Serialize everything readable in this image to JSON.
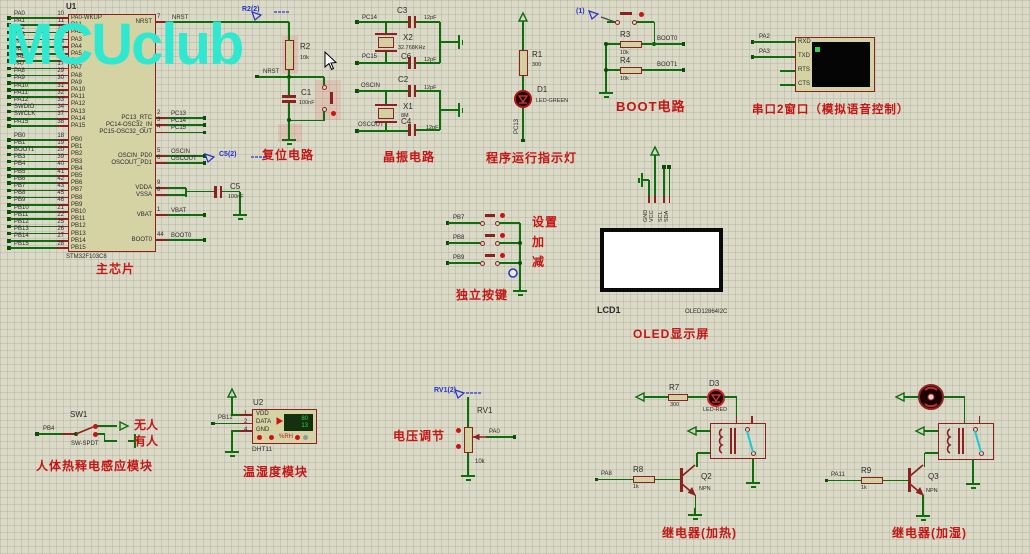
{
  "logo": {
    "text": "MCUclub"
  },
  "chip": {
    "ref": "U1",
    "part": "STM32F103C8",
    "caption": "主芯片",
    "left_pins_a": [
      [
        "PA0",
        "10",
        "PA0-WKUP"
      ],
      [
        "PA1",
        "11",
        "PA1"
      ],
      [
        "PA2",
        "12",
        "PA2"
      ],
      [
        "PA3",
        "13",
        "PA3"
      ],
      [
        "PA4",
        "14",
        "PA4"
      ],
      [
        "PA5",
        "15",
        "PA5"
      ],
      [
        "PA6",
        "16",
        "PA6"
      ],
      [
        "PA7",
        "17",
        "PA7"
      ],
      [
        "PA8",
        "29",
        "PA8"
      ],
      [
        "PA9",
        "30",
        "PA9"
      ],
      [
        "PA10",
        "31",
        "PA10"
      ],
      [
        "PA11",
        "32",
        "PA11"
      ],
      [
        "PA12",
        "33",
        "PA12"
      ],
      [
        "SWDIO",
        "34",
        "PA13"
      ],
      [
        "SWCLK",
        "37",
        "PA14"
      ],
      [
        "PA15",
        "38",
        "PA15"
      ]
    ],
    "left_pins_b": [
      [
        "PB0",
        "18",
        "PB0"
      ],
      [
        "PB1",
        "19",
        "PB1"
      ],
      [
        "BOOT1",
        "20",
        "PB2"
      ],
      [
        "PB3",
        "39",
        "PB3"
      ],
      [
        "PB4",
        "40",
        "PB4"
      ],
      [
        "PB5",
        "41",
        "PB5"
      ],
      [
        "PB6",
        "42",
        "PB6"
      ],
      [
        "PB7",
        "43",
        "PB7"
      ],
      [
        "PB8",
        "45",
        "PB8"
      ],
      [
        "PB9",
        "46",
        "PB9"
      ],
      [
        "PB10",
        "21",
        "PB10"
      ],
      [
        "PB11",
        "22",
        "PB11"
      ],
      [
        "PB12",
        "25",
        "PB12"
      ],
      [
        "PB13",
        "26",
        "PB13"
      ],
      [
        "PB14",
        "27",
        "PB14"
      ],
      [
        "PB15",
        "28",
        "PB15"
      ]
    ],
    "right_pins": [
      [
        "NRST",
        "7",
        "NRST"
      ],
      [
        "PC13_RTC",
        "2",
        "PC13"
      ],
      [
        "PC14-OSC32_IN",
        "3",
        "PC14"
      ],
      [
        "PC15-OSC32_OUT",
        "4",
        "PC15"
      ],
      [
        "OSCIN_PD0",
        "5",
        "OSCIN"
      ],
      [
        "OSCOUT_PD1",
        "6",
        "OSCOUT"
      ],
      [
        "VDDA",
        "9",
        ""
      ],
      [
        "VSSA",
        "8",
        ""
      ],
      [
        "VBAT",
        "1",
        "VBAT"
      ],
      [
        "BOOT0",
        "44",
        "BOOT0"
      ]
    ],
    "c5": {
      "ref": "C5",
      "val": "100nF",
      "probe": "C5(2)"
    }
  },
  "reset": {
    "probe": "R2(2)",
    "r": "R2",
    "rv": "10k",
    "net": "NRST",
    "c": "C1",
    "cv": "100nF",
    "caption": "复位电路"
  },
  "crystal": {
    "caption": "晶振电路",
    "nets": [
      "PC14",
      "PC15",
      "OSCIN",
      "OSCOUT"
    ],
    "c3": [
      "C3",
      "12pF"
    ],
    "c6": [
      "C6",
      "12pF"
    ],
    "c2": [
      "C2",
      "12pF"
    ],
    "c4": [
      "C4",
      "12pF"
    ],
    "x2": [
      "X2",
      "32.768KHz"
    ],
    "x1": [
      "X1",
      "8M"
    ]
  },
  "runled": {
    "r": "R1",
    "rv": "300",
    "d": "D1",
    "dp": "LED-GREEN",
    "net": "PC13",
    "caption": "程序运行指示灯"
  },
  "boot": {
    "probe": "(1)",
    "r3": [
      "R3",
      "10k",
      "BOOT0"
    ],
    "r4": [
      "R4",
      "10k",
      "BOOT1"
    ],
    "caption": "BOOT电路"
  },
  "serial": {
    "nets": [
      "PA2",
      "PA3"
    ],
    "pins": [
      "RXD",
      "TXD",
      "RTS",
      "CTS"
    ],
    "caption": "串口2窗口（模拟语音控制）"
  },
  "oled": {
    "ref": "LCD1",
    "part": "OLED12864I2C",
    "pins": [
      "GND",
      "VCC",
      "SCL",
      "SDA"
    ],
    "caption": "OLED显示屏"
  },
  "keys": {
    "caption": "独立按键",
    "rows": [
      [
        "PB7",
        "设置"
      ],
      [
        "PB8",
        "加"
      ],
      [
        "PB9",
        "减"
      ]
    ]
  },
  "pir": {
    "ref": "SW1",
    "part": "SW-SPDT",
    "net": "PB4",
    "top": "无人",
    "bottom": "有人",
    "caption": "人体热释电感应模块"
  },
  "dht": {
    "ref": "U2",
    "part": "DHT11",
    "net": "PB12",
    "pins": [
      [
        "1",
        "VDD"
      ],
      [
        "2",
        "DATA"
      ],
      [
        "4",
        "GND"
      ]
    ],
    "hum": "80",
    "temp": "13",
    "rh": "%RH",
    "caption": "温湿度模块"
  },
  "volt": {
    "probe": "RV1(2)",
    "ref": "RV1",
    "val": "10k",
    "net": "PA0",
    "caption": "电压调节"
  },
  "relay_heat": {
    "r7": [
      "R7",
      "300"
    ],
    "d3": [
      "D3",
      "LED-RED"
    ],
    "r8": [
      "R8",
      "1k"
    ],
    "net": "PA8",
    "q": [
      "Q2",
      "NPN"
    ],
    "caption": "继电器(加热)"
  },
  "relay_hum": {
    "r9": [
      "R9",
      "1k"
    ],
    "net": "PA11",
    "q": [
      "Q3",
      "NPN"
    ],
    "caption": "继电器(加湿)"
  }
}
